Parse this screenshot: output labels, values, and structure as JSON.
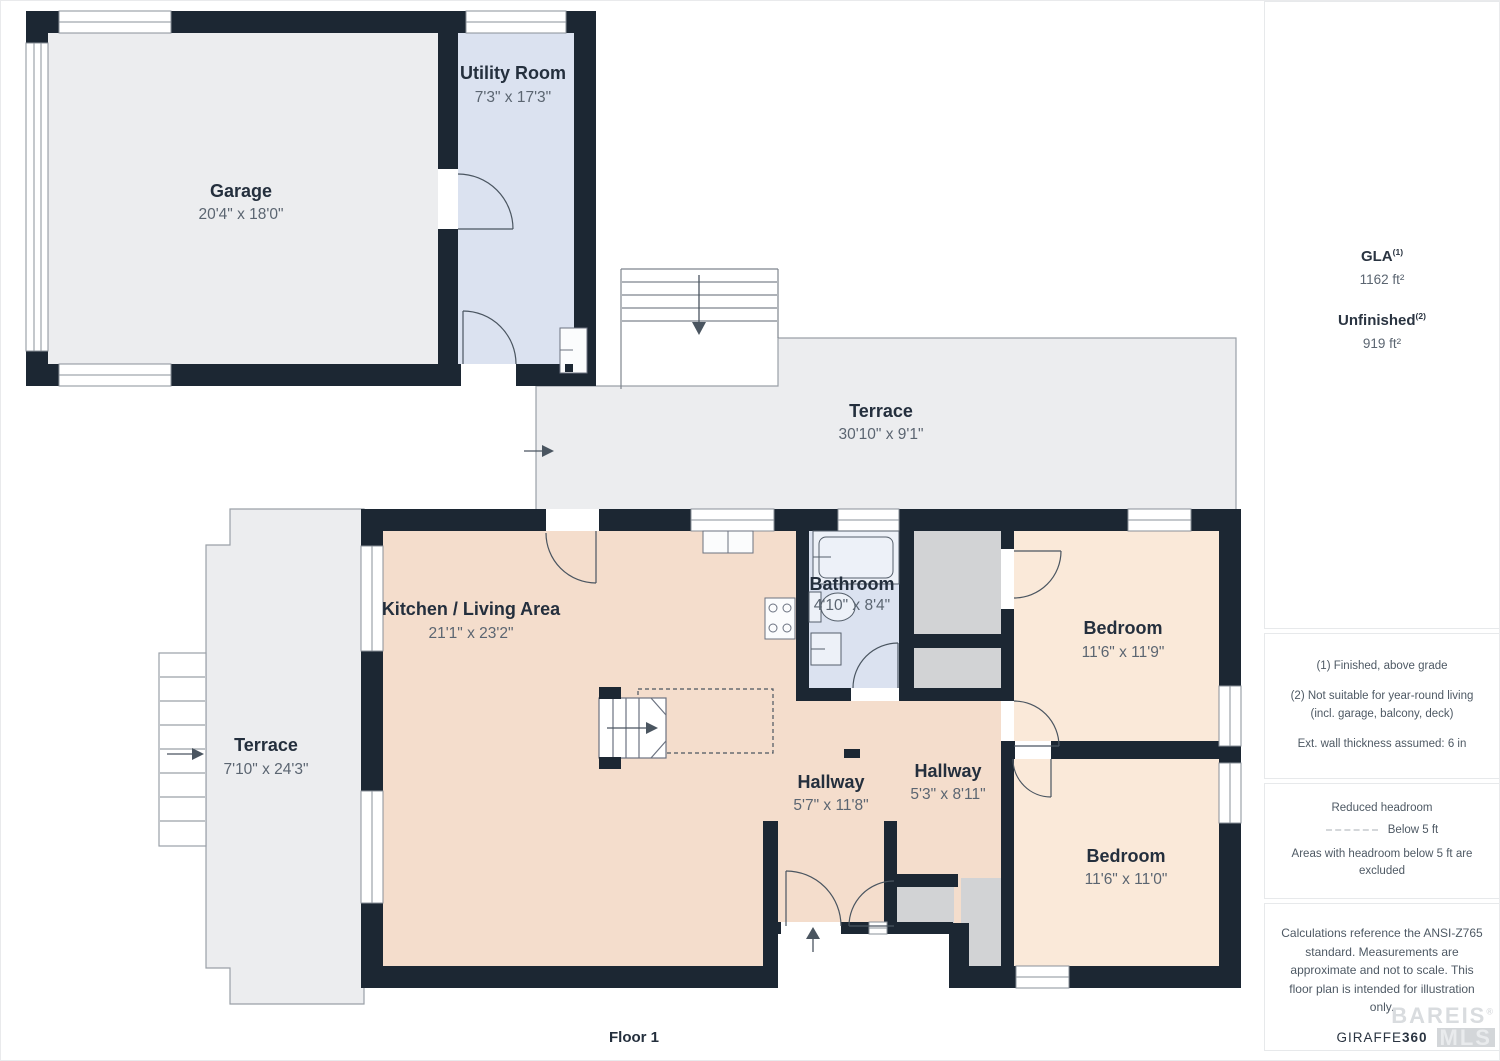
{
  "plan": {
    "floor_label": "Floor 1",
    "rooms": [
      {
        "name": "Garage",
        "dims": "20'4\" x 18'0\""
      },
      {
        "name": "Utility Room",
        "dims": "7'3\" x 17'3\""
      },
      {
        "name": "Terrace",
        "dims": "30'10\" x 9'1\""
      },
      {
        "name": "Kitchen / Living Area",
        "dims": "21'1\" x 23'2\""
      },
      {
        "name": "Bathroom",
        "dims": "4'10\" x 8'4\""
      },
      {
        "name": "Bedroom",
        "dims": "11'6\" x 11'9\""
      },
      {
        "name": "Terrace",
        "dims": "7'10\" x 24'3\""
      },
      {
        "name": "Hallway",
        "dims": "5'7\" x 11'8\""
      },
      {
        "name": "Hallway",
        "dims": "5'3\" x 8'11\""
      },
      {
        "name": "Bedroom",
        "dims": "11'6\" x 11'0\""
      }
    ]
  },
  "sidebar": {
    "gla_label": "GLA",
    "gla_sup": "(1)",
    "gla_value": "1162 ft²",
    "unfinished_label": "Unfinished",
    "unfinished_sup": "(2)",
    "unfinished_value": "919 ft²",
    "notes": [
      "(1) Finished, above grade",
      "(2) Not suitable for year-round living (incl. garage, balcony, deck)",
      "Ext. wall thickness assumed: 6 in"
    ],
    "headroom_title": "Reduced headroom",
    "headroom_legend": "Below 5 ft",
    "headroom_note": "Areas with headroom below 5 ft are excluded",
    "disclaimer": "Calculations reference the ANSI-Z765 standard. Measurements are approximate and not to scale. This floor plan is intended for illustration only.",
    "brand_name": "GIRAFFE",
    "brand_suffix": "360",
    "watermark_top": "BAREIS",
    "watermark_reg": "®",
    "watermark_bottom": "MLS"
  },
  "colors": {
    "wall": "#1C2733",
    "terrace": "#ECEDEF",
    "utility": "#DBE2F0",
    "living": "#F4DDCC",
    "bedroom": "#FAE9D9",
    "closet": "#D2D3D5"
  }
}
